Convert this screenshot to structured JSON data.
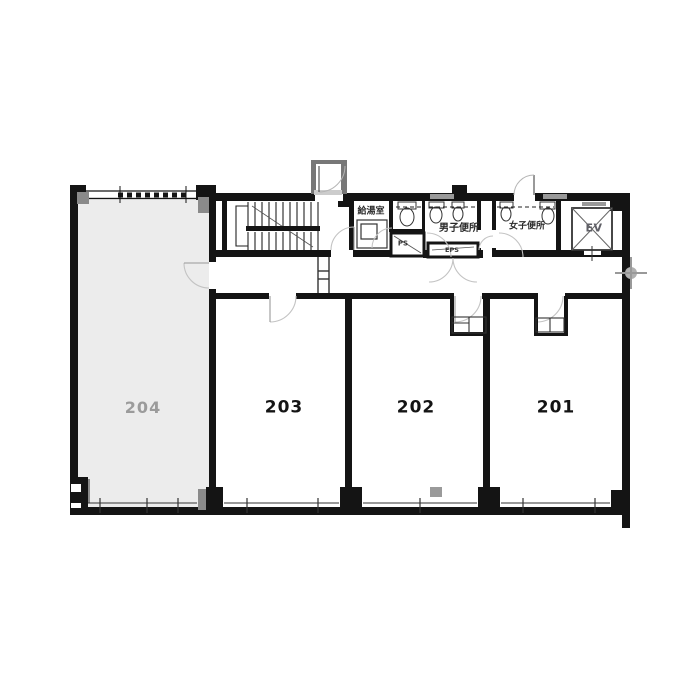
{
  "plan": {
    "rooms": {
      "r204": {
        "label": "204",
        "status": "vacant-highlighted"
      },
      "r203": {
        "label": "203"
      },
      "r202": {
        "label": "202"
      },
      "r201": {
        "label": "201"
      }
    },
    "facilities": {
      "kitchenette": {
        "label": "給湯室"
      },
      "mens_toilet": {
        "label": "男子便所"
      },
      "womens_toilet": {
        "label": "女子便所"
      },
      "elevator": {
        "label": "EV"
      },
      "pipe_shaft": {
        "label": "PS"
      },
      "electrical_pipe_shaft": {
        "label": "EPS"
      }
    },
    "colors": {
      "wall": "#141414",
      "room_204_fill": "#ececec",
      "room_204_text": "#9b9b9b",
      "room_number_text": "#141414",
      "door_arc": "#c3c3c3",
      "column_gray": "#8a8a8a"
    }
  }
}
